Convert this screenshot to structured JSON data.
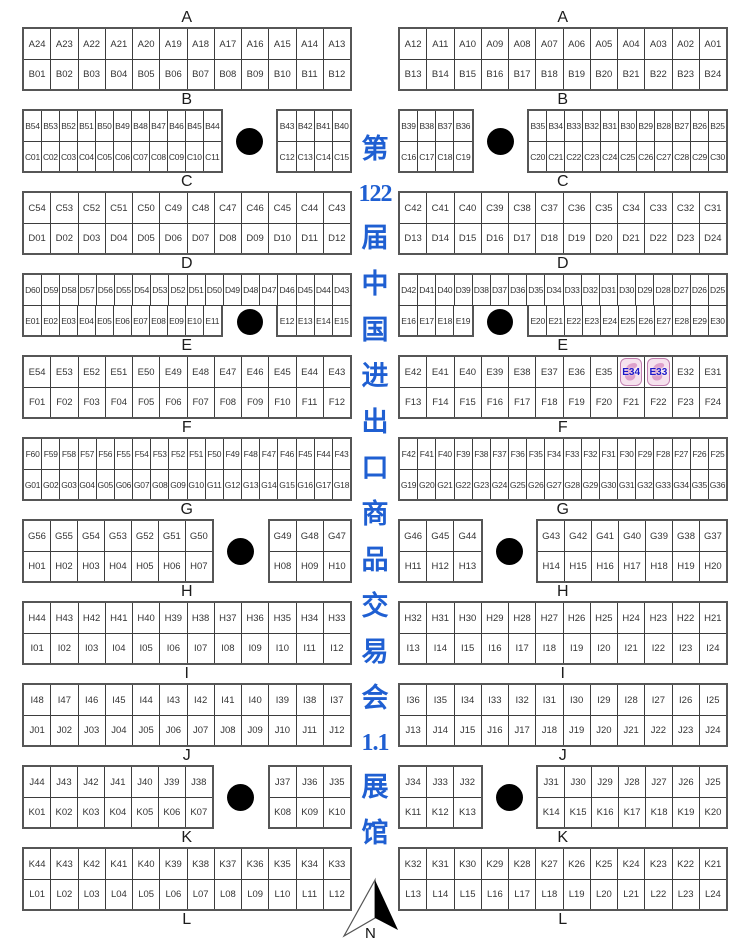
{
  "meta": {
    "hall_title_full": "第122届中国进出口商品交易会 1.1展馆",
    "hall_number": "1.1"
  },
  "title": {
    "items": [
      "第",
      "122",
      "届",
      "中",
      "国",
      "进",
      "出",
      "口",
      "商",
      "品",
      "交",
      "易",
      "会",
      "1.1",
      "展",
      "馆"
    ]
  },
  "compass": {
    "label": "N"
  },
  "colors": {
    "title_blue": "#1f5fd2",
    "booth_text": "#333333",
    "block_border": "#565656",
    "cell_border": "#3d3d3d",
    "pillar": "#000000",
    "highlight_border": "#c27fb0",
    "highlight_fill": "#f6e2ee",
    "highlight_ribbon": "#db9ac6",
    "highlight_text": "#1c18c8"
  },
  "highlighted_booths": [
    "E34",
    "E33"
  ],
  "columns": [
    {
      "side": "left",
      "items": [
        {
          "t": "label",
          "text": "A"
        },
        {
          "t": "block",
          "rows": [
            [
              "A24",
              "A23",
              "A22",
              "A21",
              "A20",
              "A19",
              "A18",
              "A17",
              "A16",
              "A15",
              "A14",
              "A13"
            ],
            [
              "B01",
              "B02",
              "B03",
              "B04",
              "B05",
              "B06",
              "B07",
              "B08",
              "B09",
              "B10",
              "B11",
              "B12"
            ]
          ]
        },
        {
          "t": "label",
          "text": "B"
        },
        {
          "t": "split",
          "flex": [
            11,
            3,
            4
          ],
          "left": [
            [
              "B54",
              "B53",
              "B52",
              "B51",
              "B50",
              "B49",
              "B48",
              "B47",
              "B46",
              "B45",
              "B44"
            ],
            [
              "C01",
              "C02",
              "C03",
              "C04",
              "C05",
              "C06",
              "C07",
              "C08",
              "C09",
              "C10",
              "C11"
            ]
          ],
          "right": [
            [
              "B43",
              "B42",
              "B41",
              "B40"
            ],
            [
              "C12",
              "C13",
              "C14",
              "C15"
            ]
          ]
        },
        {
          "t": "label",
          "text": "C"
        },
        {
          "t": "block",
          "rows": [
            [
              "C54",
              "C53",
              "C52",
              "C51",
              "C50",
              "C49",
              "C48",
              "C47",
              "C46",
              "C45",
              "C44",
              "C43"
            ],
            [
              "D01",
              "D02",
              "D03",
              "D04",
              "D05",
              "D06",
              "D07",
              "D08",
              "D09",
              "D10",
              "D11",
              "D12"
            ]
          ]
        },
        {
          "t": "label",
          "text": "D"
        },
        {
          "t": "gapblock",
          "flex": [
            11,
            3,
            4
          ],
          "top": [
            "D60",
            "D59",
            "D58",
            "D57",
            "D56",
            "D55",
            "D54",
            "D53",
            "D52",
            "D51",
            "D50",
            "D49",
            "D48",
            "D47",
            "D46",
            "D45",
            "D44",
            "D43"
          ],
          "bl": [
            "E01",
            "E02",
            "E03",
            "E04",
            "E05",
            "E06",
            "E07",
            "E08",
            "E09",
            "E10",
            "E11"
          ],
          "br": [
            "E12",
            "E13",
            "E14",
            "E15"
          ]
        },
        {
          "t": "label",
          "text": "E"
        },
        {
          "t": "block",
          "rows": [
            [
              "E54",
              "E53",
              "E52",
              "E51",
              "E50",
              "E49",
              "E48",
              "E47",
              "E46",
              "E45",
              "E44",
              "E43"
            ],
            [
              "F01",
              "F02",
              "F03",
              "F04",
              "F05",
              "F06",
              "F07",
              "F08",
              "F09",
              "F10",
              "F11",
              "F12"
            ]
          ]
        },
        {
          "t": "label",
          "text": "F"
        },
        {
          "t": "block",
          "rows": [
            [
              "F60",
              "F59",
              "F58",
              "F57",
              "F56",
              "F55",
              "F54",
              "F53",
              "F52",
              "F51",
              "F50",
              "F49",
              "F48",
              "F47",
              "F46",
              "F45",
              "F44",
              "F43"
            ],
            [
              "G01",
              "G02",
              "G03",
              "G04",
              "G05",
              "G06",
              "G07",
              "G08",
              "G09",
              "G10",
              "G11",
              "G12",
              "G13",
              "G14",
              "G15",
              "G16",
              "G17",
              "G18"
            ]
          ]
        },
        {
          "t": "label",
          "text": "G"
        },
        {
          "t": "split",
          "flex": [
            7,
            2,
            3
          ],
          "left": [
            [
              "G56",
              "G55",
              "G54",
              "G53",
              "G52",
              "G51",
              "G50"
            ],
            [
              "H01",
              "H02",
              "H03",
              "H04",
              "H05",
              "H06",
              "H07"
            ]
          ],
          "right": [
            [
              "G49",
              "G48",
              "G47"
            ],
            [
              "H08",
              "H09",
              "H10"
            ]
          ]
        },
        {
          "t": "label",
          "text": "H"
        },
        {
          "t": "block",
          "rows": [
            [
              "H44",
              "H43",
              "H42",
              "H41",
              "H40",
              "H39",
              "H38",
              "H37",
              "H36",
              "H35",
              "H34",
              "H33"
            ],
            [
              "I01",
              "I02",
              "I03",
              "I04",
              "I05",
              "I06",
              "I07",
              "I08",
              "I09",
              "I10",
              "I11",
              "I12"
            ]
          ]
        },
        {
          "t": "label",
          "text": "I"
        },
        {
          "t": "block",
          "rows": [
            [
              "I48",
              "I47",
              "I46",
              "I45",
              "I44",
              "I43",
              "I42",
              "I41",
              "I40",
              "I39",
              "I38",
              "I37"
            ],
            [
              "J01",
              "J02",
              "J03",
              "J04",
              "J05",
              "J06",
              "J07",
              "J08",
              "J09",
              "J10",
              "J11",
              "J12"
            ]
          ]
        },
        {
          "t": "label",
          "text": "J"
        },
        {
          "t": "split",
          "flex": [
            7,
            2,
            3
          ],
          "left": [
            [
              "J44",
              "J43",
              "J42",
              "J41",
              "J40",
              "J39",
              "J38"
            ],
            [
              "K01",
              "K02",
              "K03",
              "K04",
              "K05",
              "K06",
              "K07"
            ]
          ],
          "right": [
            [
              "J37",
              "J36",
              "J35"
            ],
            [
              "K08",
              "K09",
              "K10"
            ]
          ]
        },
        {
          "t": "label",
          "text": "K"
        },
        {
          "t": "block",
          "rows": [
            [
              "K44",
              "K43",
              "K42",
              "K41",
              "K40",
              "K39",
              "K38",
              "K37",
              "K36",
              "K35",
              "K34",
              "K33"
            ],
            [
              "L01",
              "L02",
              "L03",
              "L04",
              "L05",
              "L06",
              "L07",
              "L08",
              "L09",
              "L10",
              "L11",
              "L12"
            ]
          ]
        },
        {
          "t": "label",
          "text": "L"
        }
      ]
    },
    {
      "side": "right",
      "items": [
        {
          "t": "label",
          "text": "A"
        },
        {
          "t": "block",
          "rows": [
            [
              "A12",
              "A11",
              "A10",
              "A09",
              "A08",
              "A07",
              "A06",
              "A05",
              "A04",
              "A03",
              "A02",
              "A01"
            ],
            [
              "B13",
              "B14",
              "B15",
              "B16",
              "B17",
              "B18",
              "B19",
              "B20",
              "B21",
              "B22",
              "B23",
              "B24"
            ]
          ]
        },
        {
          "t": "label",
          "text": "B"
        },
        {
          "t": "split",
          "flex": [
            4,
            3,
            11
          ],
          "left": [
            [
              "B39",
              "B38",
              "B37",
              "B36"
            ],
            [
              "C16",
              "C17",
              "C18",
              "C19"
            ]
          ],
          "right": [
            [
              "B35",
              "B34",
              "B33",
              "B32",
              "B31",
              "B30",
              "B29",
              "B28",
              "B27",
              "B26",
              "B25"
            ],
            [
              "C20",
              "C21",
              "C22",
              "C23",
              "C24",
              "C25",
              "C26",
              "C27",
              "C28",
              "C29",
              "C30"
            ]
          ]
        },
        {
          "t": "label",
          "text": "C"
        },
        {
          "t": "block",
          "rows": [
            [
              "C42",
              "C41",
              "C40",
              "C39",
              "C38",
              "C37",
              "C36",
              "C35",
              "C34",
              "C33",
              "C32",
              "C31"
            ],
            [
              "D13",
              "D14",
              "D15",
              "D16",
              "D17",
              "D18",
              "D19",
              "D20",
              "D21",
              "D22",
              "D23",
              "D24"
            ]
          ]
        },
        {
          "t": "label",
          "text": "D"
        },
        {
          "t": "gapblock",
          "flex": [
            4,
            3,
            11
          ],
          "top": [
            "D42",
            "D41",
            "D40",
            "D39",
            "D38",
            "D37",
            "D36",
            "D35",
            "D34",
            "D33",
            "D32",
            "D31",
            "D30",
            "D29",
            "D28",
            "D27",
            "D26",
            "D25"
          ],
          "bl": [
            "E16",
            "E17",
            "E18",
            "E19"
          ],
          "br": [
            "E20",
            "E21",
            "E22",
            "E23",
            "E24",
            "E25",
            "E26",
            "E27",
            "E28",
            "E29",
            "E30"
          ]
        },
        {
          "t": "label",
          "text": "E"
        },
        {
          "t": "block",
          "rows": [
            [
              "E42",
              "E41",
              "E40",
              "E39",
              "E38",
              "E37",
              "E36",
              "E35",
              "E34",
              "E33",
              "E32",
              "E31"
            ],
            [
              "F13",
              "F14",
              "F15",
              "F16",
              "F17",
              "F18",
              "F19",
              "F20",
              "F21",
              "F22",
              "F23",
              "F24"
            ]
          ]
        },
        {
          "t": "label",
          "text": "F"
        },
        {
          "t": "block",
          "rows": [
            [
              "F42",
              "F41",
              "F40",
              "F39",
              "F38",
              "F37",
              "F36",
              "F35",
              "F34",
              "F33",
              "F32",
              "F31",
              "F30",
              "F29",
              "F28",
              "F27",
              "F26",
              "F25"
            ],
            [
              "G19",
              "G20",
              "G21",
              "G22",
              "G23",
              "G24",
              "G25",
              "G26",
              "G27",
              "G28",
              "G29",
              "G30",
              "G31",
              "G32",
              "G33",
              "G34",
              "G35",
              "G36"
            ]
          ]
        },
        {
          "t": "label",
          "text": "G"
        },
        {
          "t": "split",
          "flex": [
            3,
            2,
            7
          ],
          "left": [
            [
              "G46",
              "G45",
              "G44"
            ],
            [
              "H11",
              "H12",
              "H13"
            ]
          ],
          "right": [
            [
              "G43",
              "G42",
              "G41",
              "G40",
              "G39",
              "G38",
              "G37"
            ],
            [
              "H14",
              "H15",
              "H16",
              "H17",
              "H18",
              "H19",
              "H20"
            ]
          ]
        },
        {
          "t": "label",
          "text": "H"
        },
        {
          "t": "block",
          "rows": [
            [
              "H32",
              "H31",
              "H30",
              "H29",
              "H28",
              "H27",
              "H26",
              "H25",
              "H24",
              "H23",
              "H22",
              "H21"
            ],
            [
              "I13",
              "I14",
              "I15",
              "I16",
              "I17",
              "I18",
              "I19",
              "I20",
              "I21",
              "I22",
              "I23",
              "I24"
            ]
          ]
        },
        {
          "t": "label",
          "text": "I"
        },
        {
          "t": "block",
          "rows": [
            [
              "I36",
              "I35",
              "I34",
              "I33",
              "I32",
              "I31",
              "I30",
              "I29",
              "I28",
              "I27",
              "I26",
              "I25"
            ],
            [
              "J13",
              "J14",
              "J15",
              "J16",
              "J17",
              "J18",
              "J19",
              "J20",
              "J21",
              "J22",
              "J23",
              "J24"
            ]
          ]
        },
        {
          "t": "label",
          "text": "J"
        },
        {
          "t": "split",
          "flex": [
            3,
            2,
            7
          ],
          "left": [
            [
              "J34",
              "J33",
              "J32"
            ],
            [
              "K11",
              "K12",
              "K13"
            ]
          ],
          "right": [
            [
              "J31",
              "J30",
              "J29",
              "J28",
              "J27",
              "J26",
              "J25"
            ],
            [
              "K14",
              "K15",
              "K16",
              "K17",
              "K18",
              "K19",
              "K20"
            ]
          ]
        },
        {
          "t": "label",
          "text": "K"
        },
        {
          "t": "block",
          "rows": [
            [
              "K32",
              "K31",
              "K30",
              "K29",
              "K28",
              "K27",
              "K26",
              "K25",
              "K24",
              "K23",
              "K22",
              "K21"
            ],
            [
              "L13",
              "L14",
              "L15",
              "L16",
              "L17",
              "L18",
              "L19",
              "L20",
              "L21",
              "L22",
              "L23",
              "L24"
            ]
          ]
        },
        {
          "t": "label",
          "text": "L"
        }
      ]
    }
  ]
}
